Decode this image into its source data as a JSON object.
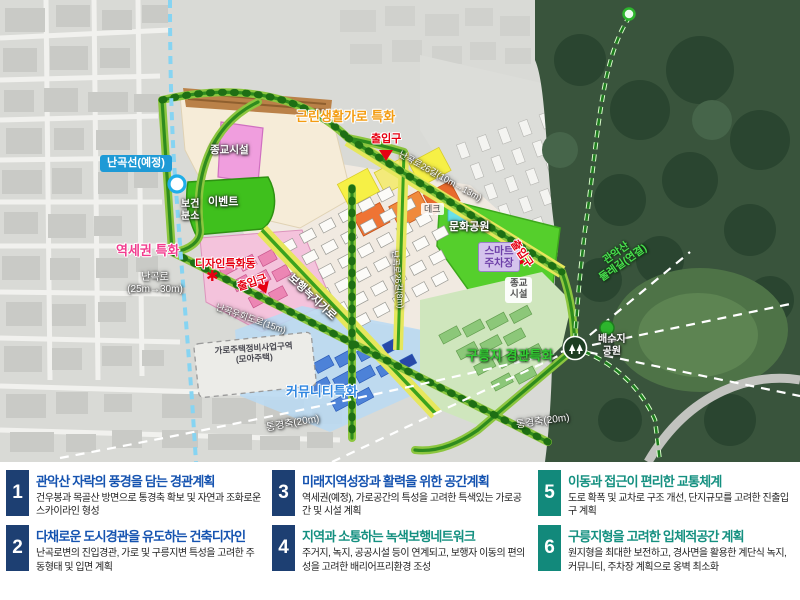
{
  "map": {
    "labels": {
      "nangok_line": "난곡선(예정)",
      "neighborhood_street": "근린생활가로 특화",
      "entrance_top": "출입구",
      "entrance_left": "출입구",
      "entrance_right": "출입구",
      "religious_zone": "종교시설",
      "religious_box_1": "종교",
      "religious_box_2": "시설",
      "health_1": "보건",
      "health_2": "분소",
      "event_area": "이벤트",
      "station_area": "역세권 특화",
      "design_building": "디자인특화동",
      "nangok_ro_1": "난곡로",
      "nangok_ro_2": "(25m→30m)",
      "bypass_road": "난곡우회도로(15m)",
      "green_walk_street": "보행녹지가로",
      "road26_small": "난곡로26길(8m)",
      "road26_wide": "난곡로26길(10m→13m)",
      "deck": "데크",
      "culture_park": "문화공원",
      "smart_parking_1": "스마트",
      "smart_parking_2": "주차장",
      "gwanak_1": "관악산",
      "gwanak_2": "둘레길(연결)",
      "reservoir_1": "배수지",
      "reservoir_2": "공원",
      "hill_landscape": "구릉지 경관특화",
      "community": "커뮤니티특화",
      "garo_housing_1": "가로주택정비사업구역",
      "garo_housing_2": "(모아주택)",
      "view_axis_1": "통경축(20m)",
      "view_axis_2": "통경축(20m)"
    },
    "icons": {
      "asterisk_marker": "✱"
    }
  },
  "panel": {
    "items": [
      {
        "num": "1",
        "title": "관악산 자락의 풍경을 담는 경관계획",
        "desc": "건우봉과 목골산 방면으로 통경축 확보 및 자연과 조화로운 스카이라인 형성"
      },
      {
        "num": "2",
        "title": "다채로운 도시경관을 유도하는 건축디자인",
        "desc": "난곡로변의 진입경관, 가로 및 구릉지변 특성을 고려한 주동형태 및 입면 계획"
      },
      {
        "num": "3",
        "title": "미래지역성장과 활력을 위한 공간계획",
        "desc": "역세권(예정), 가로공간의 특성을 고려한 특색있는 가로공간 및 시설 계획"
      },
      {
        "num": "4",
        "title": "지역과 소통하는 녹색보행네트워크",
        "desc": "주거지, 녹지, 공공시설 등이 연계되고, 보행자 이동의 편의성을 고려한 배리어프리환경 조성"
      },
      {
        "num": "5",
        "title": "이동과 접근이 편리한 교통체계",
        "desc": "도로 확폭 및 교차로 구조 개선, 단지규모를 고려한 진출입구 계획"
      },
      {
        "num": "6",
        "title": "구릉지형을 고려한 입체적공간 계획",
        "desc": "원지형을 최대한 보전하고, 경사면을 활용한 계단식 녹지, 커뮤니티, 주차장 계획으로 옹벽 최소화"
      }
    ]
  },
  "colors": {
    "accent_navy": "#1d3f72",
    "accent_teal": "#12897b",
    "title_blue": "#1553b0",
    "rail_blue": "#86d4f2",
    "road_green": "#2e8b1e",
    "park_green": "#55cf2c",
    "forest_green": "#39543c",
    "entrance_red": "#e60012",
    "street_yellow": "#e6e75c",
    "community_blue": "#2f86e0",
    "station_pink": "#f23d8f",
    "orange_label": "#f39c12"
  }
}
